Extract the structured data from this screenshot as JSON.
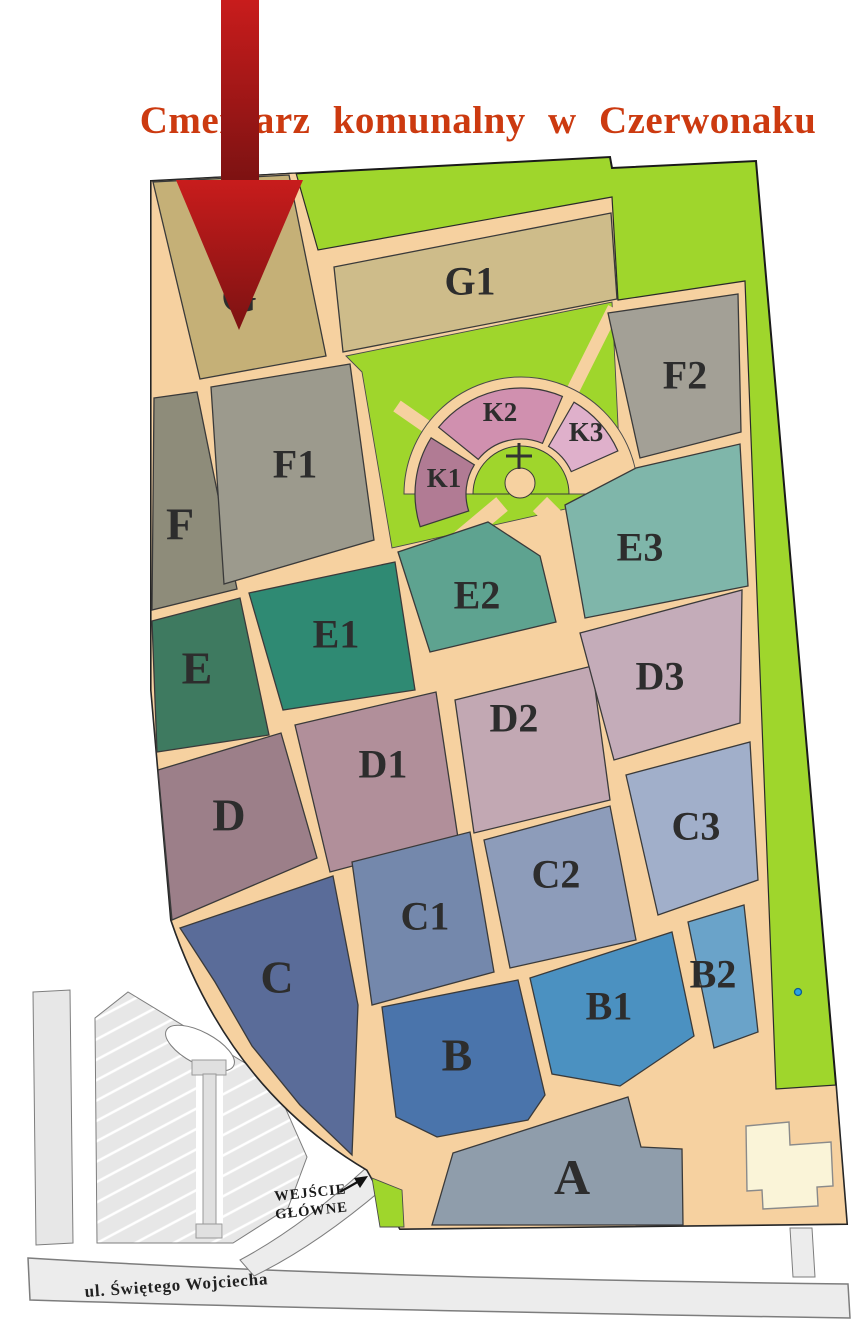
{
  "title": {
    "text": "Cmentarz komunalny w Czerwonaku",
    "color": "#cc3a10"
  },
  "entrance": {
    "line1": "WEJŚCIE",
    "line2": "GŁÓWNE"
  },
  "street": {
    "name": "ul. Świętego Wojciecha"
  },
  "map": {
    "colors": {
      "path_tan": "#f6d1a0",
      "green": "#9fd62c",
      "outline": "#1a1a1a",
      "section_stroke": "#3a3a3a",
      "road_gray": "#ececec",
      "road_stroke": "#7d7d7d",
      "parking_gray": "#e7e7e7",
      "building": "#faf4d8",
      "arrow_top": "#c81c1c",
      "arrow_bottom": "#7c1212",
      "cross": "#333333",
      "label": "#2d2d2d"
    },
    "site": {
      "outline_path": "M151,181 L610,157 L612,168 L756,161 L836,1085 L847,1224 L400,1229 L367,1170 Q228,1088 171,920 L151,690 Z",
      "body_path": "M151,181 L296,173 L318,250 L612,197 L618,300 L745,281 L776,1089 L836,1085 L847,1224 L400,1229 L367,1170 Q228,1088 171,920 L151,690 Z",
      "lawn_pts": [
        [
          346,
          356
        ],
        [
          612,
          302
        ],
        [
          620,
          466
        ],
        [
          570,
          508
        ],
        [
          392,
          548
        ],
        [
          362,
          372
        ]
      ],
      "entrance_green_pts": [
        [
          372,
          1178
        ],
        [
          402,
          1190
        ],
        [
          404,
          1227
        ],
        [
          380,
          1227
        ]
      ]
    },
    "rotunda": {
      "cx": 521,
      "cy": 494,
      "r_inner": 48,
      "r_ring_in": 55,
      "r_ring_out": 106,
      "r_disc": 117,
      "bulge": {
        "x": 520,
        "y": 483,
        "r": 15
      },
      "cross": {
        "x": 519,
        "y": 456,
        "len": 26
      },
      "k_font": 27,
      "k_sections": [
        {
          "id": "K1",
          "fill": "#b17b94",
          "a1": 198,
          "a2": 148,
          "lp": [
            444,
            478
          ]
        },
        {
          "id": "K2",
          "fill": "#d090af",
          "a1": 141,
          "a2": 67,
          "lp": [
            500,
            412
          ]
        },
        {
          "id": "K3",
          "fill": "#dfb0cb",
          "a1": 60,
          "a2": 24,
          "lp": [
            586,
            432
          ]
        }
      ],
      "spokes": [
        {
          "x1": 443,
          "y1": 438,
          "x2": 397,
          "y2": 406,
          "w": 13
        },
        {
          "x1": 564,
          "y1": 408,
          "x2": 614,
          "y2": 308,
          "w": 13
        }
      ],
      "feeders": [
        {
          "x1": 502,
          "y1": 504,
          "x2": 440,
          "y2": 556,
          "w": 18
        },
        {
          "x1": 540,
          "y1": 504,
          "x2": 596,
          "y2": 560,
          "w": 20
        }
      ]
    },
    "sections": [
      {
        "id": "G",
        "fill": "#c5b077",
        "fs": 46,
        "lp": [
          239,
          296
        ],
        "pts": [
          [
            153,
            182
          ],
          [
            289,
            175
          ],
          [
            326,
            356
          ],
          [
            200,
            379
          ]
        ]
      },
      {
        "id": "G1",
        "fill": "#cebc8a",
        "fs": 40,
        "lp": [
          470,
          281
        ],
        "pts": [
          [
            334,
            267
          ],
          [
            611,
            213
          ],
          [
            617,
            299
          ],
          [
            343,
            352
          ]
        ]
      },
      {
        "id": "F",
        "fill": "#8e8c7a",
        "fs": 46,
        "lp": [
          180,
          524
        ],
        "pts": [
          [
            154,
            398
          ],
          [
            197,
            392
          ],
          [
            237,
            589
          ],
          [
            152,
            610
          ]
        ]
      },
      {
        "id": "F1",
        "fill": "#9c9a8d",
        "fs": 40,
        "lp": [
          295,
          464
        ],
        "pts": [
          [
            211,
            387
          ],
          [
            350,
            364
          ],
          [
            374,
            540
          ],
          [
            224,
            584
          ]
        ]
      },
      {
        "id": "F2",
        "fill": "#a3a096",
        "fs": 40,
        "lp": [
          685,
          375
        ],
        "pts": [
          [
            608,
            313
          ],
          [
            738,
            294
          ],
          [
            741,
            432
          ],
          [
            640,
            458
          ]
        ]
      },
      {
        "id": "E",
        "fill": "#3e7a60",
        "fs": 46,
        "lp": [
          197,
          668
        ],
        "pts": [
          [
            152,
            621
          ],
          [
            240,
            598
          ],
          [
            269,
            735
          ],
          [
            157,
            752
          ]
        ]
      },
      {
        "id": "E1",
        "fill": "#2f8a73",
        "fs": 40,
        "lp": [
          336,
          634
        ],
        "pts": [
          [
            249,
            593
          ],
          [
            395,
            562
          ],
          [
            415,
            690
          ],
          [
            283,
            710
          ]
        ]
      },
      {
        "id": "E2",
        "fill": "#5ea390",
        "fs": 40,
        "lp": [
          477,
          595
        ],
        "pts": [
          [
            398,
            552
          ],
          [
            488,
            522
          ],
          [
            540,
            556
          ],
          [
            556,
            622
          ],
          [
            430,
            652
          ]
        ]
      },
      {
        "id": "E3",
        "fill": "#7fb6aa",
        "fs": 40,
        "lp": [
          640,
          547
        ],
        "pts": [
          [
            565,
            505
          ],
          [
            636,
            468
          ],
          [
            740,
            444
          ],
          [
            748,
            586
          ],
          [
            585,
            618
          ]
        ]
      },
      {
        "id": "D",
        "fill": "#9c7f89",
        "fs": 46,
        "lp": [
          229,
          815
        ],
        "pts": [
          [
            158,
            770
          ],
          [
            281,
            733
          ],
          [
            317,
            858
          ],
          [
            172,
            920
          ]
        ]
      },
      {
        "id": "D1",
        "fill": "#b18f9a",
        "fs": 40,
        "lp": [
          383,
          764
        ],
        "pts": [
          [
            295,
            725
          ],
          [
            436,
            692
          ],
          [
            458,
            838
          ],
          [
            330,
            872
          ]
        ]
      },
      {
        "id": "D2",
        "fill": "#c2a8b3",
        "fs": 40,
        "lp": [
          514,
          718
        ],
        "pts": [
          [
            455,
            700
          ],
          [
            592,
            666
          ],
          [
            610,
            800
          ],
          [
            474,
            833
          ]
        ]
      },
      {
        "id": "D3",
        "fill": "#c4acb9",
        "fs": 40,
        "lp": [
          660,
          676
        ],
        "pts": [
          [
            580,
            633
          ],
          [
            742,
            590
          ],
          [
            740,
            723
          ],
          [
            614,
            760
          ]
        ]
      },
      {
        "id": "C",
        "fill": "#5a6c99",
        "fs": 46,
        "lp": [
          277,
          977
        ],
        "pts": [
          [
            180,
            928
          ],
          [
            333,
            876
          ],
          [
            358,
            1005
          ],
          [
            352,
            1155
          ],
          [
            300,
            1105
          ],
          [
            252,
            1046
          ],
          [
            215,
            982
          ]
        ]
      },
      {
        "id": "C1",
        "fill": "#7488ac",
        "fs": 40,
        "lp": [
          425,
          916
        ],
        "pts": [
          [
            352,
            862
          ],
          [
            470,
            832
          ],
          [
            494,
            972
          ],
          [
            372,
            1005
          ]
        ]
      },
      {
        "id": "C2",
        "fill": "#8d9cba",
        "fs": 40,
        "lp": [
          556,
          874
        ],
        "pts": [
          [
            484,
            840
          ],
          [
            610,
            806
          ],
          [
            636,
            940
          ],
          [
            510,
            968
          ]
        ]
      },
      {
        "id": "C3",
        "fill": "#a1afca",
        "fs": 40,
        "lp": [
          696,
          826
        ],
        "pts": [
          [
            626,
            775
          ],
          [
            750,
            742
          ],
          [
            758,
            880
          ],
          [
            658,
            915
          ]
        ]
      },
      {
        "id": "B",
        "fill": "#4a74ab",
        "fs": 46,
        "lp": [
          457,
          1055
        ],
        "pts": [
          [
            382,
            1007
          ],
          [
            518,
            980
          ],
          [
            545,
            1095
          ],
          [
            528,
            1120
          ],
          [
            437,
            1137
          ],
          [
            396,
            1117
          ]
        ]
      },
      {
        "id": "B1",
        "fill": "#4b91c1",
        "fs": 40,
        "lp": [
          609,
          1006
        ],
        "pts": [
          [
            530,
            978
          ],
          [
            672,
            932
          ],
          [
            694,
            1036
          ],
          [
            620,
            1086
          ],
          [
            552,
            1074
          ]
        ]
      },
      {
        "id": "B2",
        "fill": "#6aa3c9",
        "fs": 40,
        "lp": [
          713,
          974
        ],
        "pts": [
          [
            688,
            922
          ],
          [
            744,
            905
          ],
          [
            758,
            1032
          ],
          [
            714,
            1048
          ]
        ]
      },
      {
        "id": "A",
        "fill": "#8f9dab",
        "fs": 50,
        "lp": [
          572,
          1177
        ],
        "pts": [
          [
            453,
            1153
          ],
          [
            628,
            1097
          ],
          [
            641,
            1147
          ],
          [
            682,
            1149
          ],
          [
            683,
            1225
          ],
          [
            432,
            1225
          ]
        ]
      }
    ],
    "decor": {
      "street_path": "M28,1258 Q350,1278 848,1284 L850,1318 Q350,1310 30,1300 Z",
      "connector_pts": [
        [
          790,
          1228
        ],
        [
          812,
          1228
        ],
        [
          815,
          1277
        ],
        [
          793,
          1277
        ]
      ],
      "walkway_path": "M240,1260 Q300,1228 366,1168 L386,1186 Q316,1246 254,1276 Z",
      "parking_strip_pts": [
        [
          33,
          992
        ],
        [
          70,
          990
        ],
        [
          73,
          1243
        ],
        [
          36,
          1245
        ]
      ],
      "parking_block_pts": [
        [
          95,
          1018
        ],
        [
          128,
          992
        ],
        [
          273,
          1080
        ],
        [
          307,
          1157
        ],
        [
          288,
          1208
        ],
        [
          233,
          1243
        ],
        [
          97,
          1243
        ]
      ],
      "oval": {
        "cx": 200,
        "cy": 1048,
        "rx": 38,
        "ry": 16,
        "rot": 28
      },
      "channel_pts": [
        [
          196,
          1062
        ],
        [
          223,
          1062
        ],
        [
          223,
          1238
        ],
        [
          196,
          1238
        ]
      ],
      "column": {
        "cap": [
          [
            192,
            1060
          ],
          [
            226,
            1060
          ],
          [
            226,
            1075
          ],
          [
            192,
            1075
          ]
        ],
        "stem": [
          [
            203,
            1074
          ],
          [
            216,
            1074
          ],
          [
            216,
            1226
          ],
          [
            203,
            1226
          ]
        ],
        "foot": [
          [
            196,
            1224
          ],
          [
            222,
            1224
          ],
          [
            222,
            1238
          ],
          [
            196,
            1238
          ]
        ]
      },
      "building_pts": [
        [
          746,
          1126
        ],
        [
          789,
          1122
        ],
        [
          790,
          1145
        ],
        [
          831,
          1142
        ],
        [
          833,
          1186
        ],
        [
          817,
          1187
        ],
        [
          818,
          1206
        ],
        [
          763,
          1209
        ],
        [
          762,
          1190
        ],
        [
          747,
          1191
        ]
      ]
    },
    "arrow": {
      "shaft_pts": [
        [
          221,
          0
        ],
        [
          259,
          0
        ],
        [
          259,
          183
        ],
        [
          221,
          183
        ]
      ],
      "head_pts": [
        [
          176,
          180
        ],
        [
          303,
          180
        ],
        [
          239,
          330
        ]
      ]
    },
    "marker": {
      "x": 798,
      "y": 992,
      "r": 3.5,
      "fill": "#29a3e3",
      "stroke": "#0d5e93"
    },
    "entrance_arrow": {
      "line": "M340,1192 L361,1180",
      "head_pts": "368,1176 354,1178 360,1188"
    }
  }
}
